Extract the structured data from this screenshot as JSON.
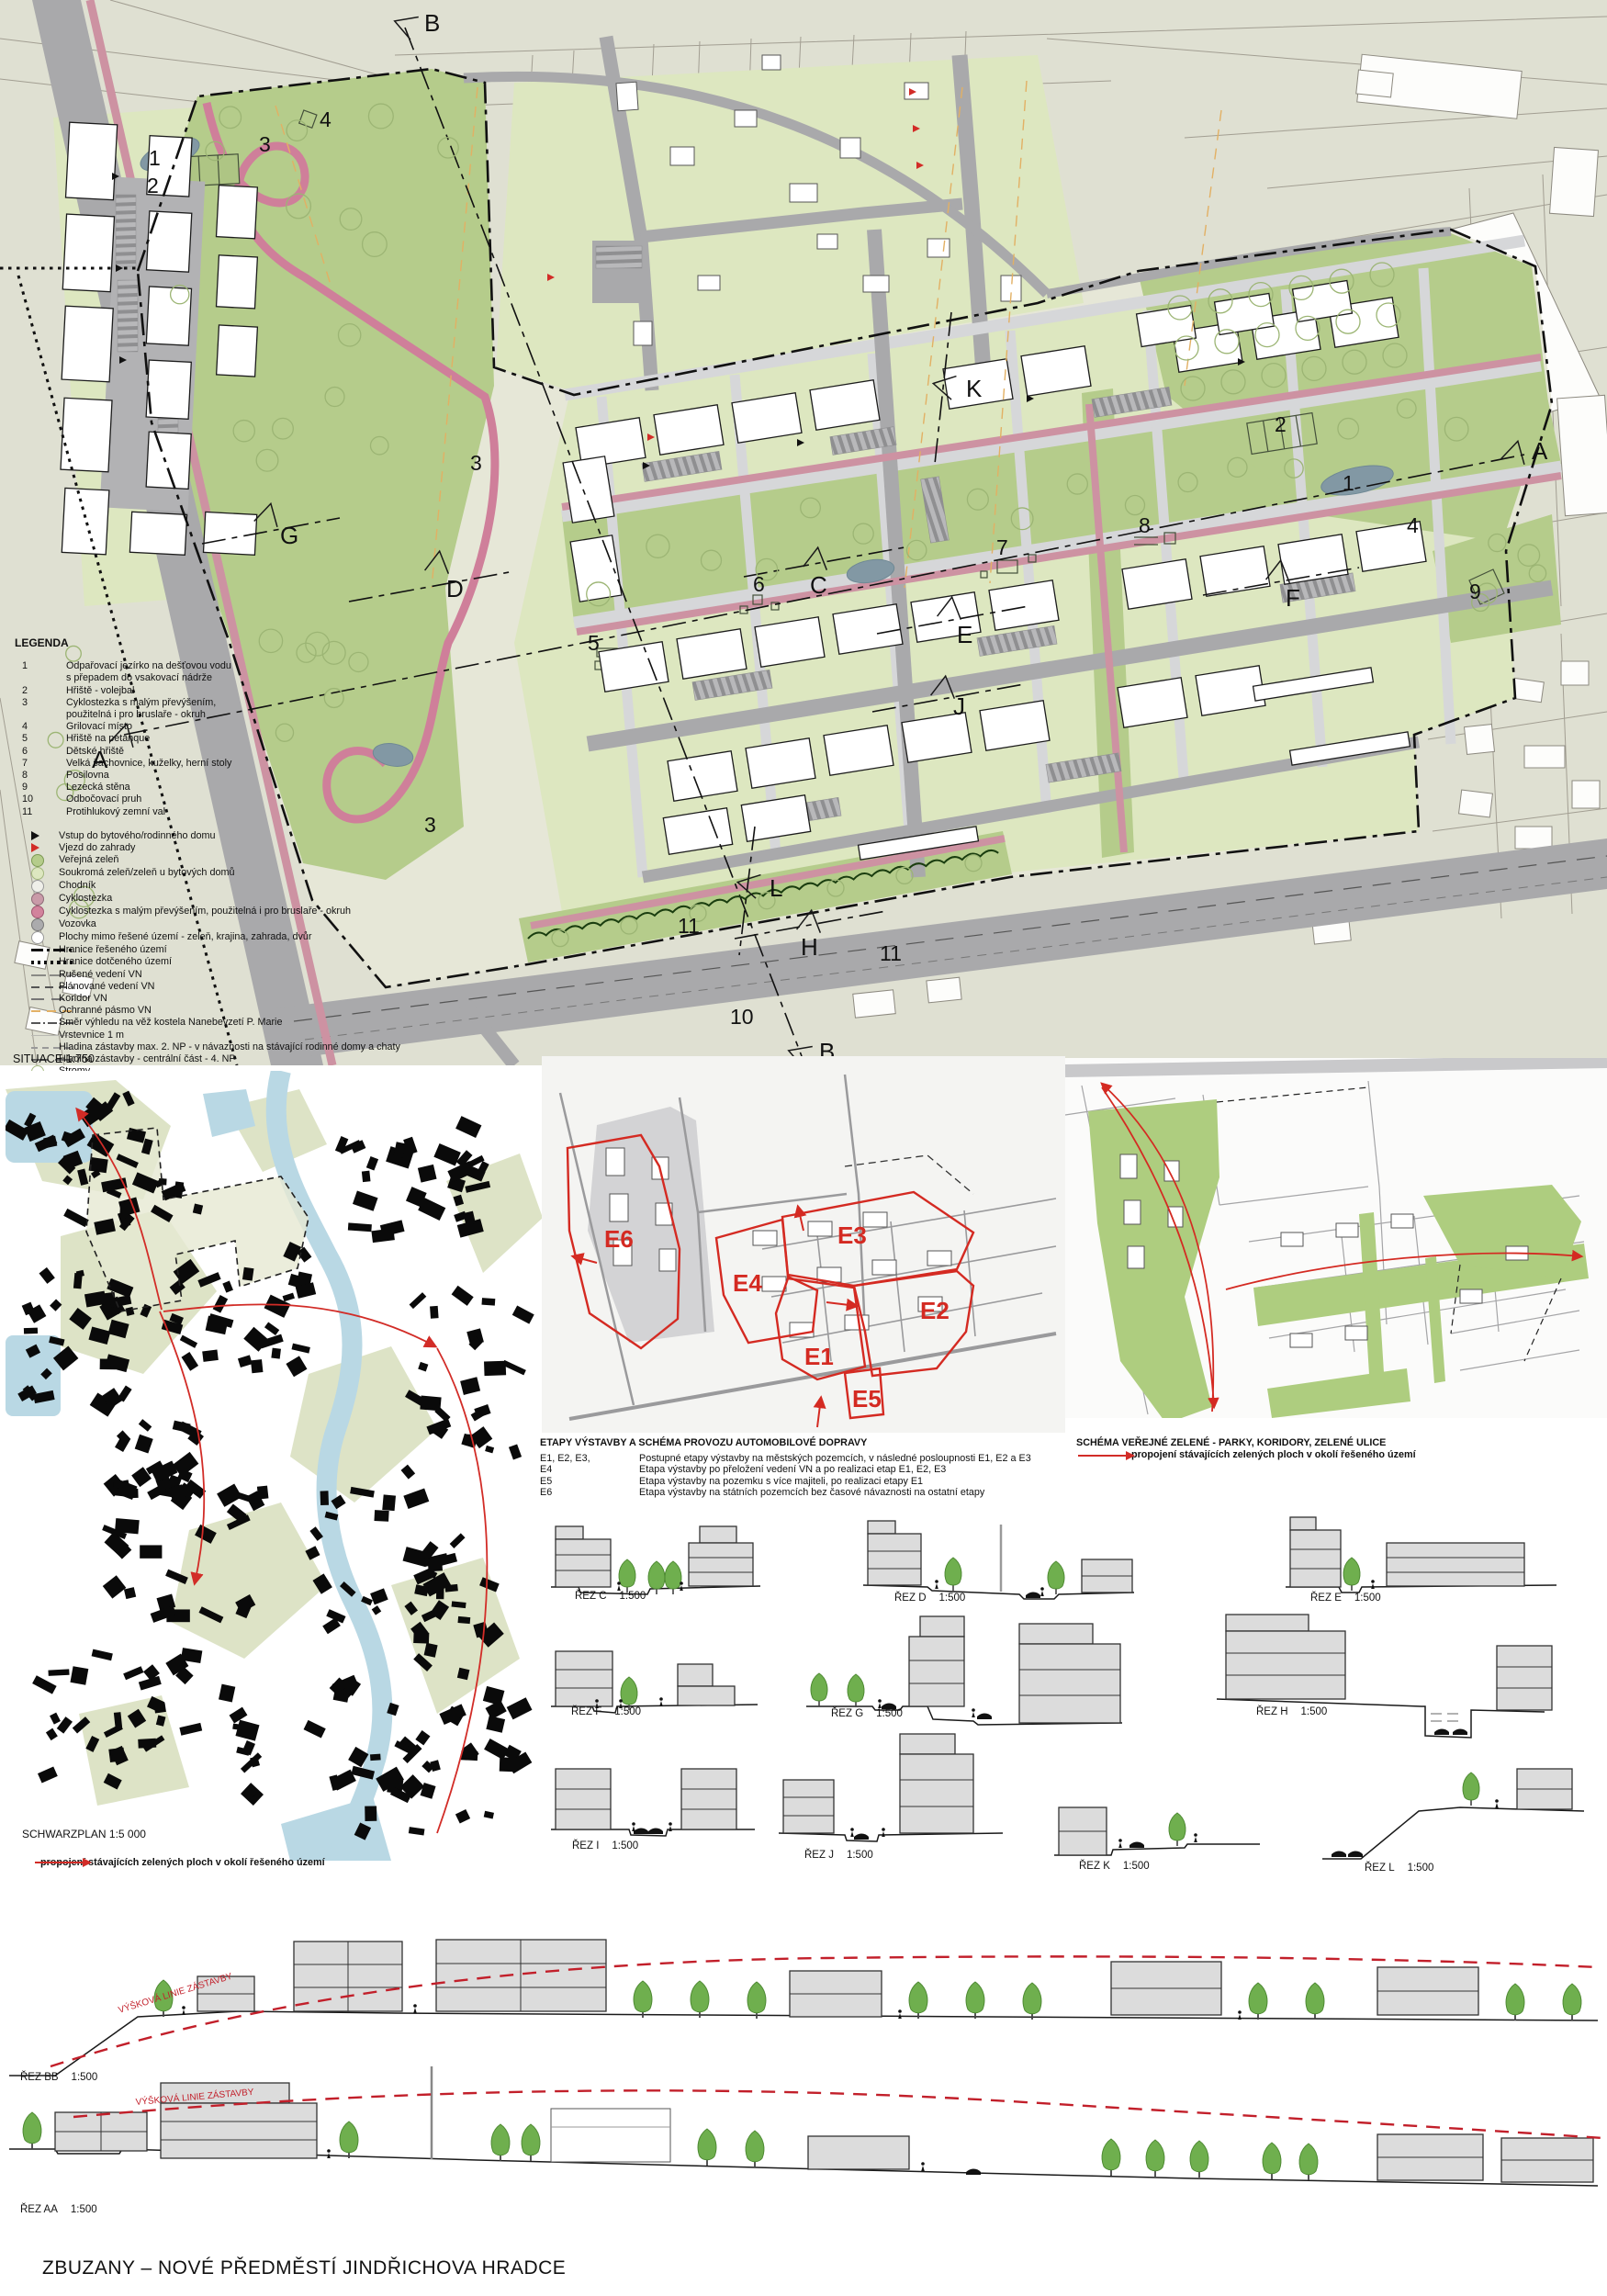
{
  "poster": {
    "title": "ZBUZANY – NOVÉ PŘEDMĚSTÍ JINDŘICHOVA HRADCE"
  },
  "plan": {
    "situace_label": "SITUACE   1:750"
  },
  "plan_labels": {
    "n1": "1",
    "n2": "2",
    "n3": "3",
    "n4": "4",
    "n5": "5",
    "n6": "6",
    "n7": "7",
    "n8": "8",
    "n9": "9",
    "n10": "10",
    "n11": "11",
    "A": "A",
    "B": "B",
    "C": "C",
    "D": "D",
    "E": "E",
    "F": "F",
    "G": "G",
    "H": "H",
    "J": "J",
    "K": "K",
    "L": "L"
  },
  "legend": {
    "title": "LEGENDA",
    "numbered": [
      {
        "num": "1",
        "text": "Odpařovací jezírko na dešťovou vodu",
        "text2": "s přepadem do vsakovací nádrže"
      },
      {
        "num": "2",
        "text": "Hřiště - volejbal"
      },
      {
        "num": "3",
        "text": "Cyklostezka s malým převýšením,",
        "text2": "použitelná i pro bruslaře - okruh"
      },
      {
        "num": "4",
        "text": "Grilovací místo"
      },
      {
        "num": "5",
        "text": "Hřiště na petanque"
      },
      {
        "num": "6",
        "text": "Dětské hřiště"
      },
      {
        "num": "7",
        "text": "Velká šachovnice, kuželky, herní stoly"
      },
      {
        "num": "8",
        "text": "Posilovna"
      },
      {
        "num": "9",
        "text": "Lezecká stěna"
      },
      {
        "num": "10",
        "text": "Odbočovací pruh"
      },
      {
        "num": "11",
        "text": "Protihlukový zemní val"
      }
    ],
    "symbols": [
      {
        "type": "triangle-black",
        "label": "Vstup do bytového/rodinného domu"
      },
      {
        "type": "triangle-red",
        "label": "Vjezd do zahrady"
      },
      {
        "type": "circle-green",
        "label": "Veřejná zeleň"
      },
      {
        "type": "circle-lightgreen",
        "label": "Soukromá zeleň/zeleň u bytových domů"
      },
      {
        "type": "circle-white",
        "label": "Chodník"
      },
      {
        "type": "circle-mauve",
        "label": "Cyklostezka"
      },
      {
        "type": "circle-pink",
        "label": "Cyklostezka s malým převýšením, použitelná i pro bruslaře - okruh"
      },
      {
        "type": "circle-gray",
        "label": "Vozovka"
      },
      {
        "type": "circle-outline",
        "label": "Plochy mimo řešené území - zeleň, krajina, zahrada, dvůr"
      },
      {
        "type": "line-dashdot",
        "label": "Hranice řešeného území"
      },
      {
        "type": "line-dotted",
        "label": "Hranice dotčeného území"
      },
      {
        "type": "line-cancelled",
        "label": "Rušené vedení VN"
      },
      {
        "type": "line-planned",
        "label": "Plánované vedení VN"
      },
      {
        "type": "line-corridor",
        "label": "Koridor VN"
      },
      {
        "type": "line-protect",
        "label": "Ochranné pásmo VN"
      },
      {
        "type": "line-viewdir",
        "label": "Směr výhledu na věž kostela Nanebevzetí P. Marie"
      },
      {
        "type": "line-contour",
        "label": "Vrstevnice 1 m"
      },
      {
        "type": "line-level2",
        "label": "Hladina zástavby max. 2. NP - v návaznosti na stávající rodinné domy a chaty"
      },
      {
        "type": "line-level4",
        "label": "Hladina zástavby - centrální část - 4. NP"
      },
      {
        "type": "circle-tree",
        "label": "Stromy"
      }
    ]
  },
  "etapy": {
    "title": "ETAPY VÝSTAVBY A SCHÉMA PROVOZU AUTOMOBILOVÉ DOPRAVY",
    "rows": [
      {
        "code": "E1, E2, E3,",
        "desc": "Postupné etapy výstavby na městských pozemcích, v následné posloupnosti E1, E2 a E3"
      },
      {
        "code": "E4",
        "desc": "Etapa výstavby po přeložení vedení VN a po realizaci etap E1, E2, E3"
      },
      {
        "code": "E5",
        "desc": "Etapa výstavby na pozemku s více majiteli, po realizaci etapy E1"
      },
      {
        "code": "E6",
        "desc": "Etapa výstavby na státních pozemcích bez časové návaznosti na ostatní etapy"
      }
    ],
    "zones": [
      "E1",
      "E2",
      "E3",
      "E4",
      "E5",
      "E6"
    ]
  },
  "zelen": {
    "title": "SCHÉMA VEŘEJNÉ ZELENÉ - PARKY, KORIDORY, ZELENÉ ULICE",
    "note": "propojení stávajících zelených ploch v okolí řešeného území"
  },
  "schwarzplan": {
    "label": "SCHWARZPLAN   1:5 000",
    "note": "propojení stávajících zelených ploch v okolí řešeného území"
  },
  "sections": {
    "items": [
      {
        "label": "ŘEZ C",
        "scale": "1:500"
      },
      {
        "label": "ŘEZ D",
        "scale": "1:500"
      },
      {
        "label": "ŘEZ E",
        "scale": "1:500"
      },
      {
        "label": "ŘEZ F",
        "scale": "1:500"
      },
      {
        "label": "ŘEZ G",
        "scale": "1:500"
      },
      {
        "label": "ŘEZ H",
        "scale": "1:500"
      },
      {
        "label": "ŘEZ I",
        "scale": "1:500"
      },
      {
        "label": "ŘEZ J",
        "scale": "1:500"
      },
      {
        "label": "ŘEZ K",
        "scale": "1:500"
      },
      {
        "label": "ŘEZ L",
        "scale": "1:500"
      }
    ]
  },
  "long_sections": [
    {
      "label": "ŘEZ BB",
      "scale": "1:500",
      "annotation": "VÝŠKOVÁ LINIE ZÁSTAVBY"
    },
    {
      "label": "ŘEZ AA",
      "scale": "1:500",
      "annotation": "VÝŠKOVÁ LINIE ZÁSTAVBY"
    }
  ],
  "colors": {
    "accent_red": "#d22c27",
    "public_green": "#b5cc8b",
    "private_green": "#dde7c0",
    "road_gray": "#a9a9ab",
    "cycle_pink": "#cd92a2",
    "water": "#8298a4"
  }
}
